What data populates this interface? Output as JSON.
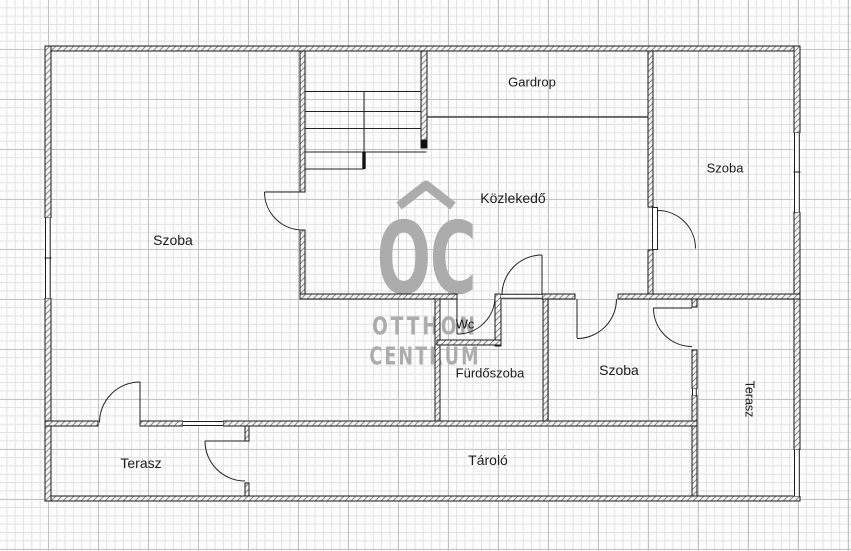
{
  "rooms": {
    "szoba_left": "Szoba",
    "gardrop": "Gardrop",
    "kozlekedo": "Közlekedő",
    "szoba_top_right": "Szoba",
    "wc": "Wc",
    "furdoszoba": "Fürdőszoba",
    "szoba_middle": "Szoba",
    "terasz_right": "Terasz",
    "terasz_bottom": "Terasz",
    "tarolo": "Tároló"
  },
  "watermark": {
    "logo_text": "OC",
    "brand_line1": "OTTHON",
    "brand_line2": "CENTRUM"
  },
  "colors": {
    "wall_line": "#1a1a1a",
    "hatch_stroke": "#8c8c8c",
    "watermark_gray": "#acacac",
    "label_text": "#1c1c1c"
  }
}
